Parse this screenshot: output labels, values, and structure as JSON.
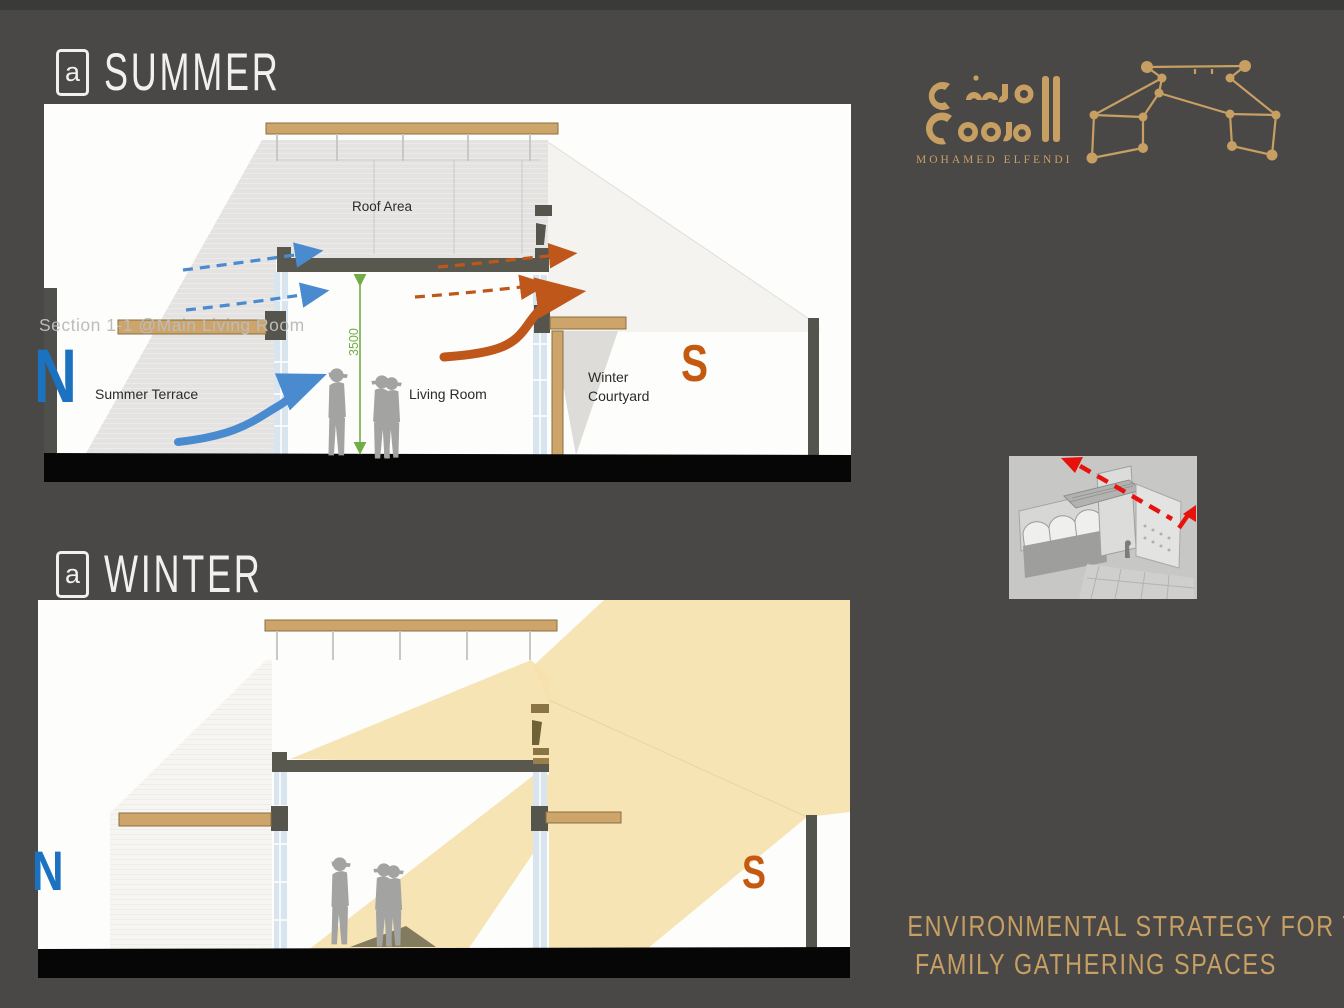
{
  "slide": {
    "background": "#494846",
    "accent": "#c79f62",
    "at_glyph": "a",
    "titles": {
      "summer": "SUMMER",
      "winter": "WINTER"
    },
    "caption": {
      "line1": "ENVIRONMENTAL STRATEGY FOR THE",
      "line2": "FAMILY GATHERING SPACES"
    },
    "logo": {
      "name": "MOHAMED ELFENDI"
    }
  },
  "summer_diagram": {
    "section_caption": "Section 1-1 @Main Living Room",
    "labels": {
      "roof_area": "Roof Area",
      "summer_terrace": "Summer  Terrace",
      "living_room": "Living Room",
      "winter_courtyard_line1": "Winter",
      "winter_courtyard_line2": "Courtyard"
    },
    "compass": {
      "north": "N",
      "south": "S"
    },
    "dimension_mm": "3500",
    "colors": {
      "cool_breeze_blue": "#4a8bd0",
      "hot_air_orange": "#c0571a",
      "dimension_green": "#70ad47"
    }
  },
  "winter_diagram": {
    "compass": {
      "north": "N",
      "south": "S"
    },
    "sun_ray_color": "#f6e2ae"
  }
}
